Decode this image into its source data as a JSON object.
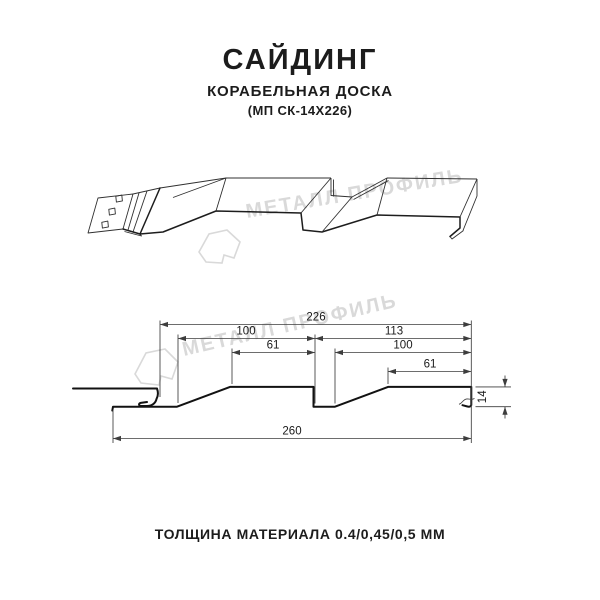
{
  "header": {
    "title": "САЙДИНГ",
    "subtitle": "КОРАБЕЛЬНАЯ ДОСКА",
    "model": "(МП СК-14Х226)"
  },
  "watermark": {
    "brand": "МЕТАЛЛ ПРОФИЛЬ"
  },
  "section": {
    "dimensions": {
      "panel_width": "226",
      "left_pitch": "100",
      "left_flat": "61",
      "right_span": "113",
      "right_pitch": "100",
      "right_flat": "61",
      "overall_width": "260",
      "profile_height": "14"
    }
  },
  "footer": {
    "thickness": "ТОЛЩИНА МАТЕРИАЛА 0.4/0,45/0,5 ММ"
  }
}
